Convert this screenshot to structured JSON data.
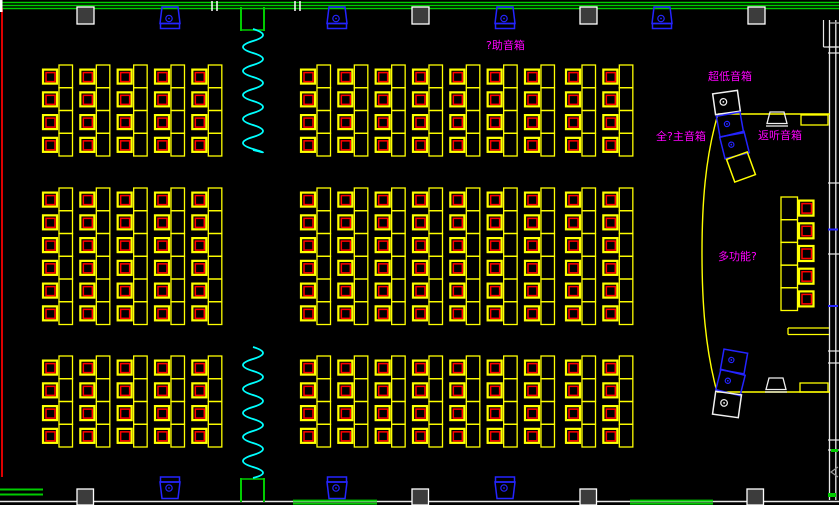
{
  "drawing": {
    "type": "cad-floor-plan",
    "canvas": {
      "width": 839,
      "height": 505,
      "background": "#000000"
    },
    "palette": {
      "desk_yellow": "#ffff00",
      "chair_red": "#ff0000",
      "wall_green": "#00cc00",
      "wall_white": "#f0f0f0",
      "wall_red": "#dd0000",
      "speaker_blue": "#2424ff",
      "spring_cyan": "#00ffff",
      "label_magenta": "#ff00ff",
      "column_fill": "#3c3c3c",
      "gray": "#999999"
    },
    "labels": [
      {
        "id": "auxiliary-speaker-label",
        "text": "?助音箱",
        "x": 486,
        "y": 40
      },
      {
        "id": "subwoofer-label",
        "text": "超低音箱",
        "x": 708,
        "y": 71
      },
      {
        "id": "main-speaker-label",
        "text": "全?主音箱",
        "x": 656,
        "y": 131
      },
      {
        "id": "monitor-speaker-label",
        "text": "返听音箱",
        "x": 758,
        "y": 130
      },
      {
        "id": "multi-function-label",
        "text": "多功能?",
        "x": 718,
        "y": 251
      }
    ],
    "seat_blocks": [
      {
        "name": "seat-block-top-left",
        "x": 43,
        "y": 65,
        "cols": 5,
        "rows": 4
      },
      {
        "name": "seat-block-top-center",
        "x": 301,
        "y": 65,
        "cols": 7,
        "rows": 4
      },
      {
        "name": "seat-block-top-right",
        "x": 566,
        "y": 65,
        "cols": 2,
        "rows": 4
      },
      {
        "name": "seat-block-mid-left",
        "x": 43,
        "y": 188,
        "cols": 5,
        "rows": 6
      },
      {
        "name": "seat-block-mid-center",
        "x": 301,
        "y": 188,
        "cols": 7,
        "rows": 6
      },
      {
        "name": "seat-block-mid-right",
        "x": 566,
        "y": 188,
        "cols": 2,
        "rows": 6
      },
      {
        "name": "seat-block-bottom-left",
        "x": 43,
        "y": 356,
        "cols": 5,
        "rows": 4
      },
      {
        "name": "seat-block-bottom-center",
        "x": 301,
        "y": 356,
        "cols": 7,
        "rows": 4
      },
      {
        "name": "seat-block-bottom-right",
        "x": 566,
        "y": 356,
        "cols": 2,
        "rows": 4
      }
    ],
    "seat_geometry": {
      "col_pitch": 37.33,
      "row_pitch": 22.75,
      "chair_w": 14,
      "chair_h": 14,
      "chair_dy": 4.6,
      "chair_inset": 3,
      "desk_dx": 16,
      "desk_w": 13.5
    },
    "stage_seat_column": {
      "name": "stage-seat-column",
      "x": 781,
      "y": 197,
      "rows": 5,
      "pitch": 22.7,
      "desk_w": 16.5,
      "chair_dx": 18,
      "chair_w": 14.5
    },
    "structural_columns": {
      "top": {
        "y": 7,
        "w": 17,
        "h": 17,
        "x": [
          77,
          412,
          580,
          748
        ]
      },
      "bottom": {
        "y": 489,
        "w": 16.5,
        "h": 16,
        "x": [
          77,
          412,
          580,
          747
        ]
      }
    },
    "wall_speakers": {
      "top_x": [
        170,
        337,
        505,
        662
      ],
      "bottom_x": [
        170,
        337,
        505
      ]
    },
    "walls": {
      "top_line_ys": [
        2.5,
        5.5,
        8.5
      ],
      "break_marks_x": [
        [
          212,
          217
        ],
        [
          295,
          300
        ]
      ],
      "bottom_white_y": 501.5,
      "bottom_green_segments": [
        {
          "x1": 0,
          "x2": 43,
          "ys": [
            489.5,
            494.5
          ]
        },
        {
          "x1": 293,
          "x2": 377,
          "ys": [
            500.6,
            503.6
          ]
        },
        {
          "x1": 630,
          "x2": 713,
          "ys": [
            500.6,
            503.6
          ]
        }
      ],
      "left_red": {
        "x": 2,
        "y1": 8,
        "y2": 477
      },
      "right": {
        "x_inner": 829.5,
        "x_outer": 835.8,
        "y1": 20,
        "y2": 500,
        "white_ticks_y": [
          47,
          53,
          183,
          254,
          351,
          363,
          440,
          450
        ],
        "blue_ticks_y": [
          229.5,
          306
        ]
      }
    },
    "doors": [
      {
        "name": "door-top",
        "x1": 241,
        "x2": 264,
        "y1": 7,
        "y2": 31,
        "bar_y": 30
      },
      {
        "name": "door-bottom",
        "x1": 241,
        "x2": 264,
        "y1": 478,
        "y2": 502,
        "bar_y": 479
      }
    ],
    "springs": [
      {
        "name": "spring-symbol-top",
        "x": 253,
        "y1": 29,
        "y2": 150,
        "amp": 10,
        "step": 12
      },
      {
        "name": "spring-symbol-bottom",
        "x": 253,
        "y1": 347,
        "y2": 478,
        "amp": 10,
        "step": 12
      }
    ],
    "stage": {
      "top_edge": {
        "x1": 718,
        "x2": 830,
        "y": 114
      },
      "bottom_edge": {
        "x1": 717,
        "x2": 830,
        "y": 392
      },
      "curve": "M 718 114 C 705 158 702 205 702 253 C 702 301 705 348 717 392",
      "step_top": {
        "x": 801,
        "y": 115,
        "w": 27,
        "h": 10
      },
      "step_bottom": {
        "x": 800,
        "y": 383,
        "w": 28,
        "h": 9
      },
      "side_table": {
        "x1": 788,
        "x2": 829,
        "ys": [
          328,
          334.5
        ]
      }
    }
  }
}
